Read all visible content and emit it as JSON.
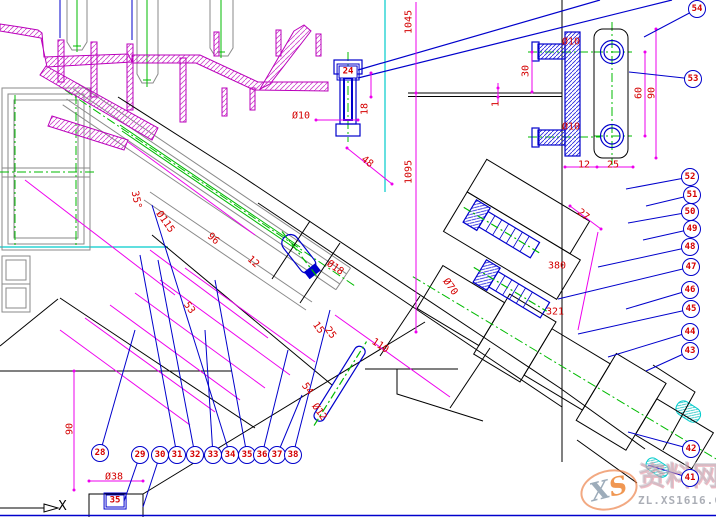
{
  "colors": {
    "dimension_text": "#d40000",
    "dimension_line": "#ee00ee",
    "balloon_stroke": "#0000cc",
    "balloon_number": "#d40000",
    "leader_blue": "#0000cc",
    "section_magenta": "#bb00bb",
    "centerline_green": "#00bb00",
    "construction_cyan": "#00cccc",
    "geometry_gray": "#8a8a8a",
    "geometry_black": "#000000"
  },
  "axis": {
    "label": "X"
  },
  "watermark": {
    "logo_x": "X",
    "logo_s": "S",
    "site_name": "资料网",
    "site_url": "ZL.XS1616.COM"
  },
  "boxed_labels": [
    {
      "n": "24",
      "x": 348,
      "y": 72
    },
    {
      "n": "35",
      "x": 115,
      "y": 501
    }
  ],
  "balloons": [
    {
      "n": "28",
      "x": 100,
      "y": 453,
      "lx": 135,
      "ly": 330
    },
    {
      "n": "29",
      "x": 140,
      "y": 455,
      "lx": 122,
      "ly": 507
    },
    {
      "n": "30",
      "x": 160,
      "y": 455,
      "lx": 143,
      "ly": 507
    },
    {
      "n": "31",
      "x": 177,
      "y": 455,
      "lx": 140,
      "ly": 255
    },
    {
      "n": "32",
      "x": 195,
      "y": 455,
      "lx": 158,
      "ly": 260
    },
    {
      "n": "33",
      "x": 213,
      "y": 455,
      "lx": 205,
      "ly": 330
    },
    {
      "n": "34",
      "x": 230,
      "y": 455,
      "lx": 152,
      "ly": 205
    },
    {
      "n": "35",
      "x": 247,
      "y": 455,
      "lx": 215,
      "ly": 280
    },
    {
      "n": "36",
      "x": 262,
      "y": 455,
      "lx": 288,
      "ly": 350
    },
    {
      "n": "37",
      "x": 277,
      "y": 455,
      "lx": 302,
      "ly": 395
    },
    {
      "n": "38",
      "x": 293,
      "y": 455,
      "lx": 330,
      "ly": 310
    },
    {
      "n": "41",
      "x": 690,
      "y": 478,
      "lx": 648,
      "ly": 465
    },
    {
      "n": "42",
      "x": 691,
      "y": 449,
      "lx": 628,
      "ly": 432
    },
    {
      "n": "43",
      "x": 690,
      "y": 351,
      "lx": 646,
      "ly": 371
    },
    {
      "n": "44",
      "x": 690,
      "y": 332,
      "lx": 608,
      "ly": 357
    },
    {
      "n": "45",
      "x": 691,
      "y": 309,
      "lx": 578,
      "ly": 334
    },
    {
      "n": "46",
      "x": 690,
      "y": 290,
      "lx": 626,
      "ly": 309
    },
    {
      "n": "47",
      "x": 691,
      "y": 267,
      "lx": 558,
      "ly": 299
    },
    {
      "n": "48",
      "x": 690,
      "y": 247,
      "lx": 598,
      "ly": 267
    },
    {
      "n": "49",
      "x": 692,
      "y": 229,
      "lx": 643,
      "ly": 240
    },
    {
      "n": "50",
      "x": 690,
      "y": 212,
      "lx": 628,
      "ly": 223
    },
    {
      "n": "51",
      "x": 692,
      "y": 195,
      "lx": 646,
      "ly": 206
    },
    {
      "n": "52",
      "x": 690,
      "y": 177,
      "lx": 626,
      "ly": 189
    },
    {
      "n": "53",
      "x": 693,
      "y": 79,
      "lx": 629,
      "ly": 72
    },
    {
      "n": "54",
      "x": 697,
      "y": 9,
      "lx": 644,
      "ly": 37
    }
  ],
  "dimensions": [
    {
      "text": "1045",
      "x": 409,
      "y": 22,
      "rot": -90
    },
    {
      "text": "1095",
      "x": 409,
      "y": 172,
      "rot": -90
    },
    {
      "text": "18",
      "x": 365,
      "y": 109,
      "rot": -90
    },
    {
      "text": "1",
      "x": 496,
      "y": 104,
      "rot": -90
    },
    {
      "text": "Ø10",
      "x": 301,
      "y": 116,
      "rot": 0
    },
    {
      "text": "30",
      "x": 526,
      "y": 71,
      "rot": -90
    },
    {
      "text": "Ø10",
      "x": 571,
      "y": 42,
      "rot": 0
    },
    {
      "text": "Ø10",
      "x": 571,
      "y": 127,
      "rot": 0
    },
    {
      "text": "60",
      "x": 639,
      "y": 93,
      "rot": -90
    },
    {
      "text": "90",
      "x": 652,
      "y": 93,
      "rot": -90
    },
    {
      "text": "12",
      "x": 584,
      "y": 165,
      "rot": 0
    },
    {
      "text": "25",
      "x": 613,
      "y": 165,
      "rot": 0
    },
    {
      "text": "48",
      "x": 367,
      "y": 162,
      "rot": 38
    },
    {
      "text": "27",
      "x": 583,
      "y": 215,
      "rot": 40
    },
    {
      "text": "35°",
      "x": 136,
      "y": 200,
      "rot": 78
    },
    {
      "text": "Ø115",
      "x": 165,
      "y": 222,
      "rot": 55
    },
    {
      "text": "96",
      "x": 213,
      "y": 239,
      "rot": 42
    },
    {
      "text": "12",
      "x": 253,
      "y": 262,
      "rot": 42
    },
    {
      "text": "53",
      "x": 189,
      "y": 308,
      "rot": 55
    },
    {
      "text": "Ø18",
      "x": 335,
      "y": 268,
      "rot": 35
    },
    {
      "text": "15",
      "x": 318,
      "y": 328,
      "rot": 55
    },
    {
      "text": "25",
      "x": 330,
      "y": 333,
      "rot": 55
    },
    {
      "text": "110",
      "x": 380,
      "y": 346,
      "rot": 33
    },
    {
      "text": "Ø70",
      "x": 450,
      "y": 287,
      "rot": 55
    },
    {
      "text": "54",
      "x": 307,
      "y": 389,
      "rot": 55
    },
    {
      "text": "Ø12",
      "x": 319,
      "y": 412,
      "rot": 55
    },
    {
      "text": "380",
      "x": 557,
      "y": 266,
      "rot": 0
    },
    {
      "text": "321",
      "x": 555,
      "y": 312,
      "rot": 0
    },
    {
      "text": "90",
      "x": 70,
      "y": 429,
      "rot": -90
    },
    {
      "text": "Ø38",
      "x": 114,
      "y": 477,
      "rot": 0
    }
  ]
}
